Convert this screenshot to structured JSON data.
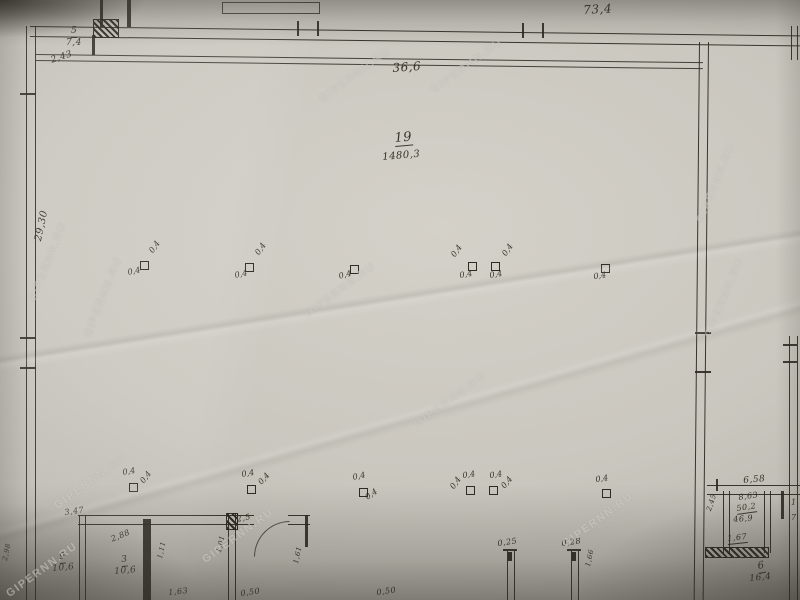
{
  "watermark": {
    "text": "GIPERNN.RU",
    "instances": [
      {
        "x": 355,
        "y": 75,
        "r": -36
      },
      {
        "x": 467,
        "y": 66,
        "r": -36
      },
      {
        "x": 48,
        "y": 262,
        "r": -68
      },
      {
        "x": 103,
        "y": 297,
        "r": -68
      },
      {
        "x": 340,
        "y": 290,
        "r": -36
      },
      {
        "x": 450,
        "y": 400,
        "r": -36
      },
      {
        "x": 716,
        "y": 183,
        "r": -68
      },
      {
        "x": 724,
        "y": 298,
        "r": -68
      },
      {
        "x": 238,
        "y": 536,
        "r": -36
      },
      {
        "x": 598,
        "y": 520,
        "r": -36
      },
      {
        "x": 42,
        "y": 570,
        "r": -36
      },
      {
        "x": 90,
        "y": 482,
        "r": -36
      }
    ]
  },
  "plan": {
    "main_room": {
      "number": "19",
      "area": "1480,3"
    },
    "column_size": "0,4",
    "labels": [
      {
        "t": "73,4",
        "x": 583,
        "y": 4,
        "s": 12,
        "r": -3
      },
      {
        "t": "36,6",
        "x": 392,
        "y": 62,
        "s": 12,
        "r": -4
      },
      {
        "t": "5",
        "x": 71,
        "y": 27,
        "s": 9,
        "r": 0,
        "u": true
      },
      {
        "t": "7,4",
        "x": 66,
        "y": 39,
        "s": 9,
        "r": 0
      },
      {
        "t": "2,43",
        "x": 50,
        "y": 57,
        "s": 9,
        "r": -18
      },
      {
        "t": "19",
        "x": 394,
        "y": 132,
        "s": 13,
        "r": -5,
        "u": true
      },
      {
        "t": "1480,3",
        "x": 382,
        "y": 153,
        "s": 10,
        "r": -5
      },
      {
        "t": "29,30",
        "x": 34,
        "y": 240,
        "s": 10,
        "r": -78
      },
      {
        "t": "3,47",
        "x": 64,
        "y": 509,
        "s": 8,
        "r": -8
      },
      {
        "t": "2,88",
        "x": 110,
        "y": 536,
        "s": 8,
        "r": -22
      },
      {
        "t": "9",
        "x": 59,
        "y": 553,
        "s": 9,
        "r": -5,
        "u": true
      },
      {
        "t": "10,6",
        "x": 52,
        "y": 565,
        "s": 9,
        "r": -5
      },
      {
        "t": "3",
        "x": 121,
        "y": 556,
        "s": 9,
        "r": -5,
        "u": true
      },
      {
        "t": "10,6",
        "x": 114,
        "y": 568,
        "s": 9,
        "r": -5
      },
      {
        "t": "2,98",
        "x": 2,
        "y": 560,
        "s": 7,
        "r": -78
      },
      {
        "t": "1,11",
        "x": 157,
        "y": 558,
        "s": 7,
        "r": -78
      },
      {
        "t": "1,63",
        "x": 168,
        "y": 589,
        "s": 8,
        "r": -6
      },
      {
        "t": "2,5",
        "x": 236,
        "y": 516,
        "s": 8,
        "r": -12
      },
      {
        "t": "1,01",
        "x": 216,
        "y": 552,
        "s": 7,
        "r": -78
      },
      {
        "t": "0,50",
        "x": 240,
        "y": 590,
        "s": 8,
        "r": -8
      },
      {
        "t": "1,61",
        "x": 293,
        "y": 563,
        "s": 7,
        "r": -78
      },
      {
        "t": "0,50",
        "x": 376,
        "y": 589,
        "s": 8,
        "r": -8
      },
      {
        "t": "0,25",
        "x": 497,
        "y": 540,
        "s": 8,
        "r": -8
      },
      {
        "t": "0,28",
        "x": 561,
        "y": 540,
        "s": 8,
        "r": -8
      },
      {
        "t": "1,66",
        "x": 585,
        "y": 566,
        "s": 7,
        "r": -78
      },
      {
        "t": "6,58",
        "x": 743,
        "y": 477,
        "s": 9,
        "r": -5
      },
      {
        "t": "8,63",
        "x": 738,
        "y": 494,
        "s": 8,
        "r": -8
      },
      {
        "t": "50,2",
        "x": 736,
        "y": 505,
        "s": 8,
        "r": -8,
        "u": true
      },
      {
        "t": "46,9",
        "x": 733,
        "y": 516,
        "s": 8,
        "r": -5
      },
      {
        "t": "2,45",
        "x": 706,
        "y": 510,
        "s": 7,
        "r": -72
      },
      {
        "t": "1,67",
        "x": 727,
        "y": 535,
        "s": 8,
        "r": -6,
        "u": true
      },
      {
        "t": "6",
        "x": 757,
        "y": 562,
        "s": 10,
        "r": -10,
        "u": true
      },
      {
        "t": "16,4",
        "x": 749,
        "y": 575,
        "s": 9,
        "r": -6
      },
      {
        "t": "1",
        "x": 791,
        "y": 499,
        "s": 8,
        "r": 0
      },
      {
        "t": "7",
        "x": 791,
        "y": 514,
        "s": 8,
        "r": 0
      }
    ],
    "columns": [
      {
        "x": 140,
        "y": 261,
        "marks": [
          {
            "t": "0,4",
            "dx": -13,
            "dy": 8,
            "r": -12
          },
          {
            "t": "0,4",
            "dx": 8,
            "dy": -11,
            "r": -55
          }
        ]
      },
      {
        "x": 245,
        "y": 263,
        "marks": [
          {
            "t": "0,4",
            "dx": -11,
            "dy": 9,
            "r": -12
          },
          {
            "t": "0,4",
            "dx": 9,
            "dy": -11,
            "r": -55
          }
        ]
      },
      {
        "x": 350,
        "y": 265,
        "marks": [
          {
            "t": "0,4",
            "dx": -12,
            "dy": 8,
            "r": -15
          }
        ]
      },
      {
        "x": 468,
        "y": 262,
        "marks": [
          {
            "t": "0,4",
            "dx": -9,
            "dy": 10,
            "r": -10
          },
          {
            "t": "0,4",
            "dx": -18,
            "dy": -8,
            "r": -55
          }
        ]
      },
      {
        "x": 491,
        "y": 262,
        "marks": [
          {
            "t": "0,4",
            "dx": -2,
            "dy": 10,
            "r": -10
          },
          {
            "t": "0,4",
            "dx": 10,
            "dy": -9,
            "r": -55
          }
        ]
      },
      {
        "x": 601,
        "y": 264,
        "marks": [
          {
            "t": "0,4",
            "dx": -8,
            "dy": 9,
            "r": -8
          }
        ]
      },
      {
        "x": 129,
        "y": 483,
        "marks": [
          {
            "t": "0,4",
            "dx": -7,
            "dy": -14,
            "r": -10
          },
          {
            "t": "0,4",
            "dx": 10,
            "dy": -3,
            "r": -52
          }
        ]
      },
      {
        "x": 247,
        "y": 485,
        "marks": [
          {
            "t": "0,4",
            "dx": -6,
            "dy": -14,
            "r": -10
          },
          {
            "t": "0,4",
            "dx": 10,
            "dy": -4,
            "r": -48
          }
        ]
      },
      {
        "x": 359,
        "y": 488,
        "marks": [
          {
            "t": "0,4",
            "dx": -7,
            "dy": -14,
            "r": -12
          },
          {
            "t": "0,4",
            "dx": 5,
            "dy": 7,
            "r": -35
          }
        ]
      },
      {
        "x": 466,
        "y": 486,
        "marks": [
          {
            "t": "0,4",
            "dx": -4,
            "dy": -14,
            "r": -8
          },
          {
            "t": "0,4",
            "dx": -17,
            "dy": 0,
            "r": -55
          }
        ]
      },
      {
        "x": 489,
        "y": 486,
        "marks": [
          {
            "t": "0,4",
            "dx": 0,
            "dy": -14,
            "r": -8
          },
          {
            "t": "0,4",
            "dx": 11,
            "dy": -1,
            "r": -50
          }
        ]
      },
      {
        "x": 602,
        "y": 489,
        "marks": [
          {
            "t": "0,4",
            "dx": -7,
            "dy": -13,
            "r": -8
          }
        ]
      }
    ]
  }
}
